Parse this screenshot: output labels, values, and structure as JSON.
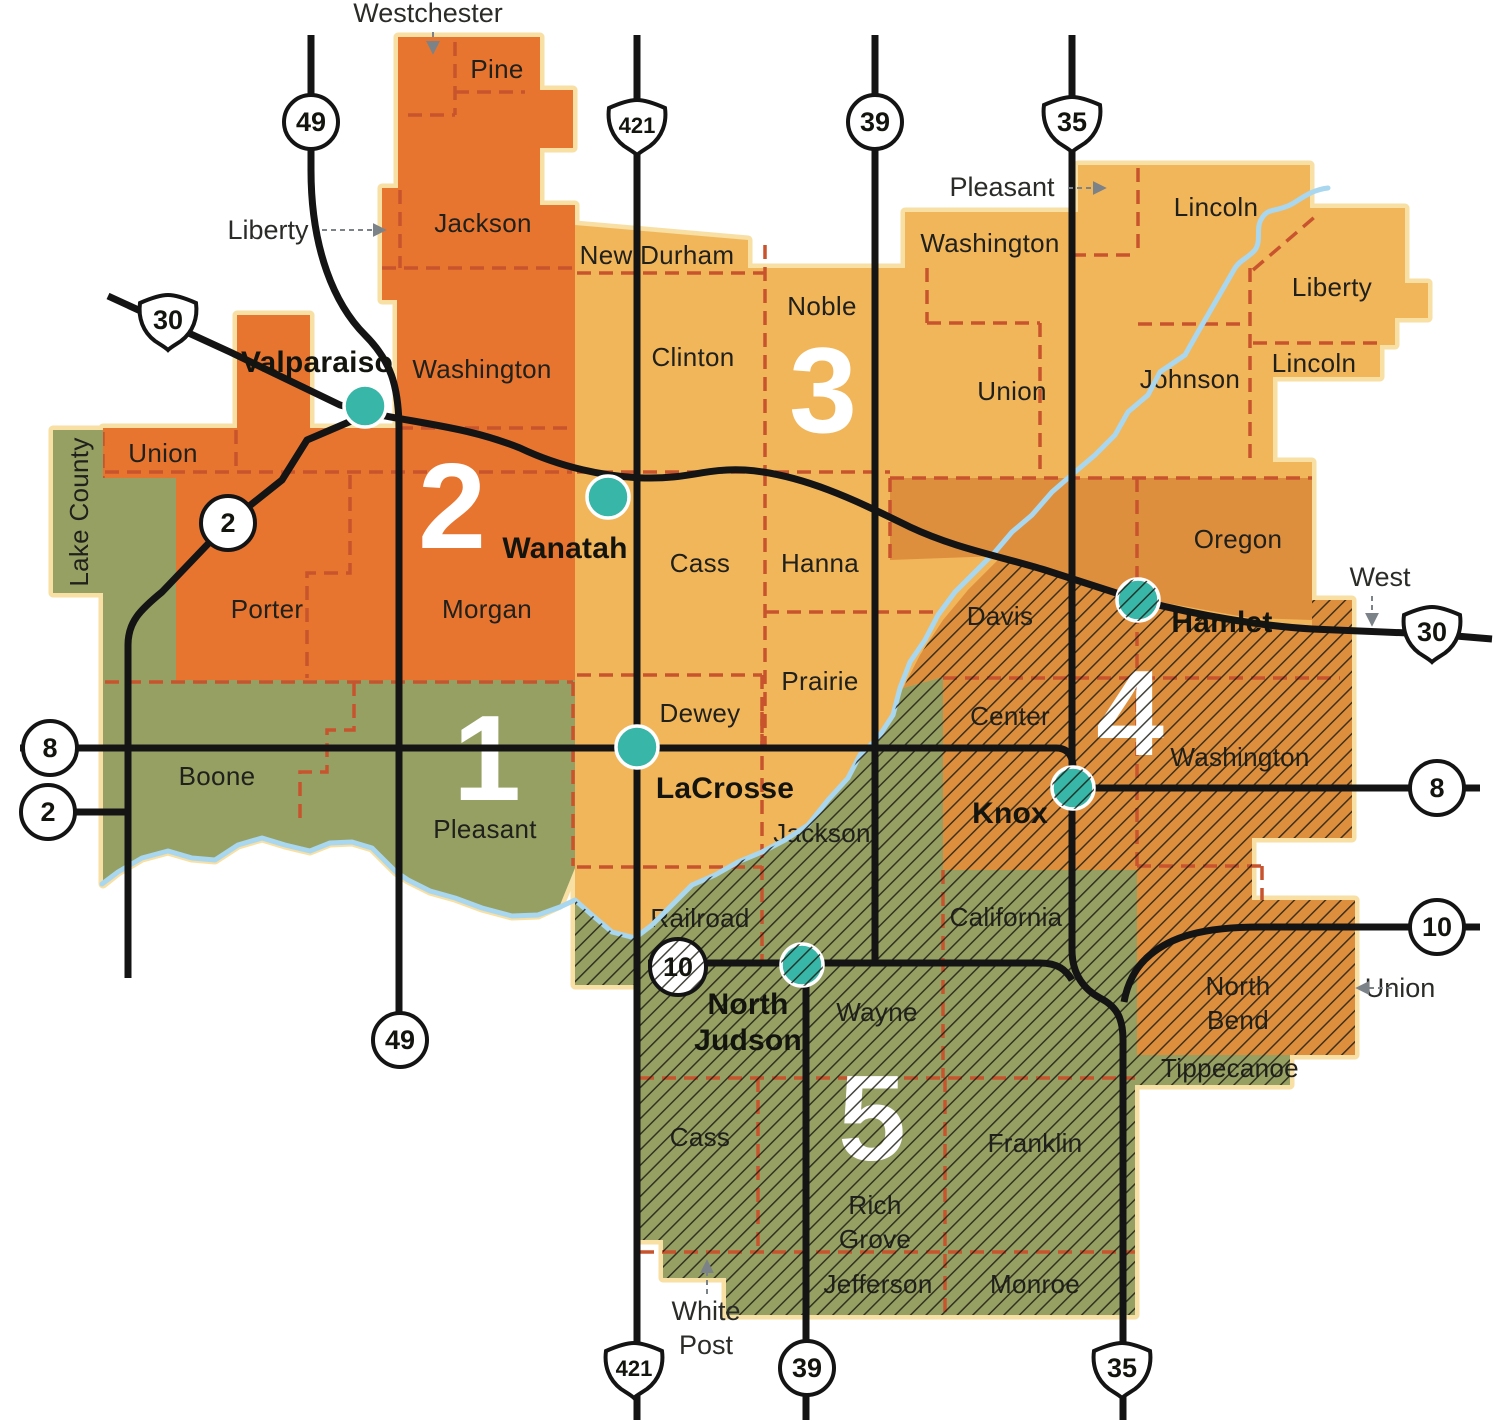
{
  "colors": {
    "district1_green": "#96A063",
    "district2_orange": "#E8752F",
    "district3_amber": "#F2B65A",
    "district4_orange": "#DE8F3E",
    "district5_green": "#96A063",
    "town_dot_teal": "#38B6A8",
    "boundary_sienna": "#C8542E",
    "river_blue": "#A9D7EF",
    "road_black": "#141414",
    "map_edge_cream": "#F8DFA3",
    "label_dark": "#20201C",
    "district_number_white": "#FFFFFF"
  },
  "districts": {
    "d1": {
      "number": "1"
    },
    "d2": {
      "number": "2"
    },
    "d3": {
      "number": "3"
    },
    "d4": {
      "number": "4"
    },
    "d5": {
      "number": "5"
    }
  },
  "townships": {
    "d2_pine": "Pine",
    "d2_jackson": "Jackson",
    "d2_washington": "Washington",
    "d2_morgan": "Morgan",
    "d2_union": "Union",
    "d2_porter": "Porter",
    "d3_new_durham": "New Durham",
    "d3_clinton": "Clinton",
    "d3_noble": "Noble",
    "d3_washington": "Washington",
    "d3_union": "Union",
    "d3_lincoln_north": "Lincoln",
    "d3_liberty": "Liberty",
    "d3_lincoln_south": "Lincoln",
    "d3_johnson": "Johnson",
    "d3_cass": "Cass",
    "d3_hanna": "Hanna",
    "d3_prairie": "Prairie",
    "d3_dewey": "Dewey",
    "d1_boone": "Boone",
    "d1_pleasant": "Pleasant",
    "d4_oregon": "Oregon",
    "d4_davis": "Davis",
    "d4_center": "Center",
    "d4_washington": "Washington",
    "d4_north_bend_1": "North",
    "d4_north_bend_2": "Bend",
    "d5_jackson": "Jackson",
    "d5_railroad": "Railroad",
    "d5_california": "California",
    "d5_wayne": "Wayne",
    "d5_cass": "Cass",
    "d5_rich_grove_1": "Rich",
    "d5_rich_grove_2": "Grove",
    "d5_franklin": "Franklin",
    "d5_jefferson": "Jefferson",
    "d5_monroe": "Monroe",
    "d5_tippecanoe": "Tippecanoe"
  },
  "towns": {
    "valparaiso": "Valparaiso",
    "wanatah": "Wanatah",
    "lacrosse": "LaCrosse",
    "hamlet": "Hamlet",
    "knox": "Knox",
    "north_judson_1": "North",
    "north_judson_2": "Judson"
  },
  "callouts": {
    "westchester": "Westchester",
    "liberty": "Liberty",
    "pleasant": "Pleasant",
    "west": "West",
    "union": "Union",
    "white_post_1": "White",
    "white_post_2": "Post",
    "lake_county": "Lake County"
  },
  "highways": {
    "sr49": "49",
    "us421": "421",
    "sr39": "39",
    "us35": "35",
    "us30": "30",
    "sr2": "2",
    "sr8": "8",
    "sr10": "10"
  }
}
